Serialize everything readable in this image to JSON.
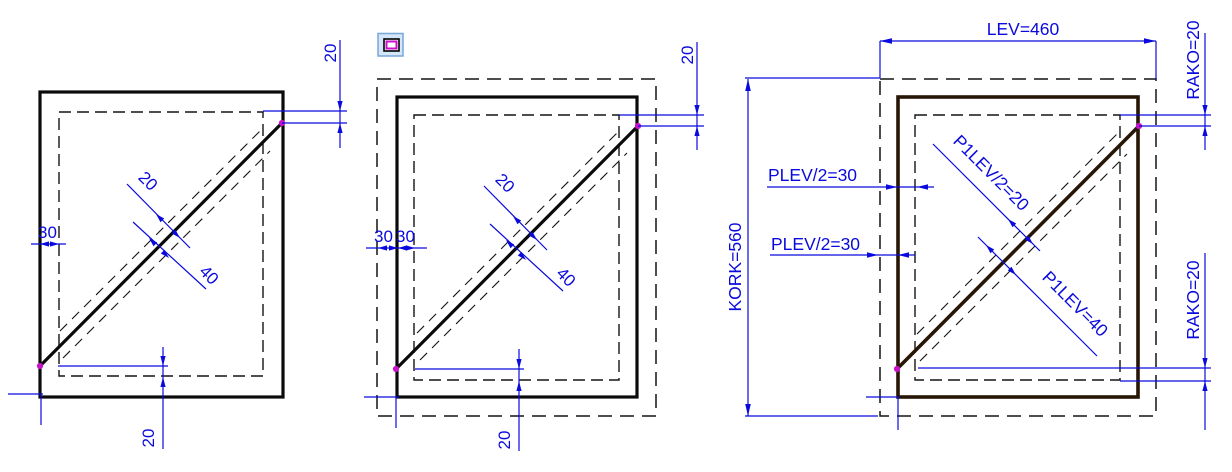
{
  "drawing": {
    "background": "#ffffff",
    "colors": {
      "dimension_blue": "#0a0ade",
      "outline_black": "#0a0a0a",
      "outline_dark_brown": "#271605",
      "endpoint_magenta": "#c911c9",
      "icon_background": "#d4e6f8",
      "icon_border": "#78a6d8",
      "icon_inner_outline": "#000000",
      "icon_inner_magenta": "#c911c9"
    },
    "panels": {
      "left": {
        "dimensions": {
          "top_right": "20",
          "left": "30",
          "diagonal_width_half": "20",
          "diagonal_width": "40",
          "bottom": "20"
        }
      },
      "middle": {
        "dimensions": {
          "top_right": "20",
          "left_outer": "30",
          "left_inner": "30",
          "diagonal_width_half": "20",
          "diagonal_width": "40",
          "bottom": "20"
        }
      },
      "right": {
        "dimensions": {
          "width": "LEV=460",
          "corner_top": "RAKO=20",
          "frame_left_outer": "PLEV/2=30",
          "frame_left_inner": "PLEV/2=30",
          "height": "KORK=560",
          "diagonal_width_half": "P1LEV/2=20",
          "diagonal_width": "P1LEV=40",
          "corner_bottom": "RAKO=20"
        }
      }
    }
  }
}
